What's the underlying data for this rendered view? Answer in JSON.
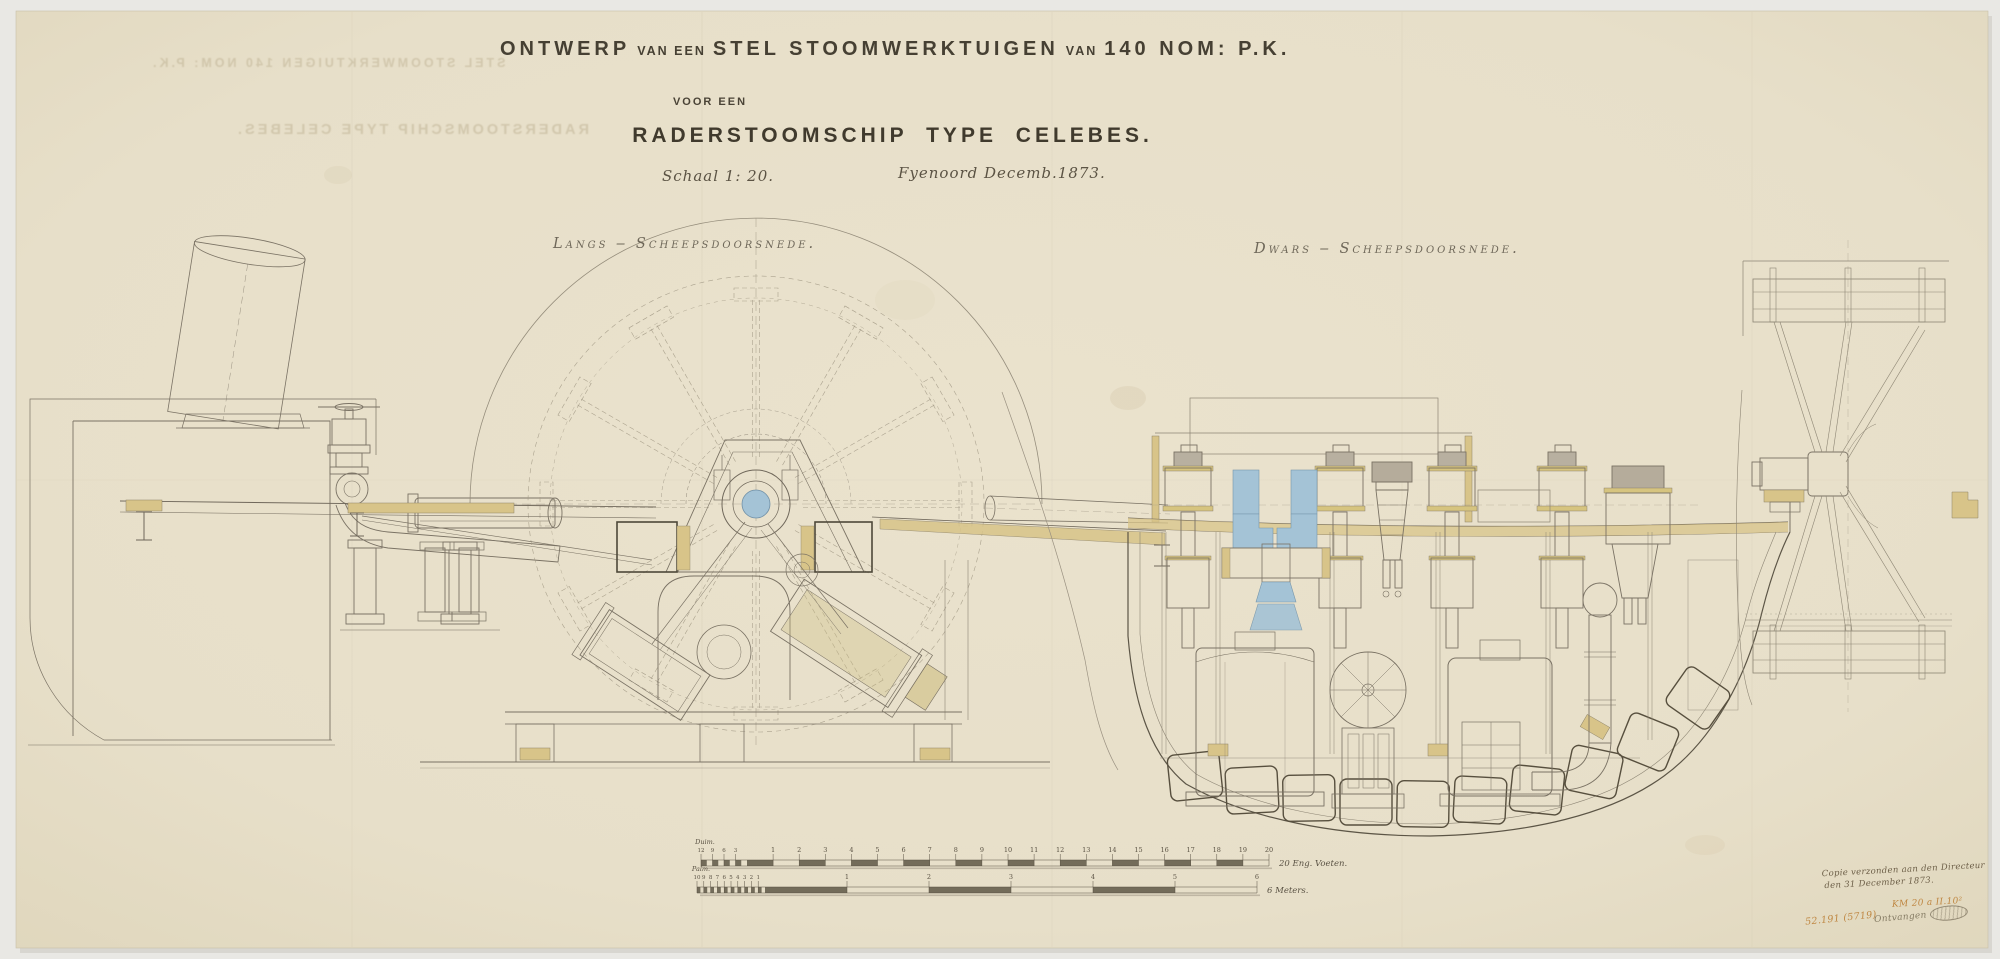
{
  "header": {
    "t1": "ONTWERP",
    "t2": "VAN EEN",
    "t3": "STEL STOOMWERKTUIGEN",
    "t4": "VAN",
    "t5": "140 NOM: P.K.",
    "subtitle": "VOOR EEN",
    "vessel_title": "RADERSTOOMSCHIP TYPE CELEBES.",
    "scale_note": "Schaal 1: 20.",
    "place_date": "Fyenoord Decemb.1873."
  },
  "section_labels": {
    "longitudinal": "Langs ‒ Scheepsdoorsnede.",
    "transverse": "Dwars ‒ Scheepsdoorsnede."
  },
  "ghost_text": {
    "line1": "STEL STOOMWERKTUIGEN  140 NOM: P.K.",
    "line2": "RADERSTOOMSCHIP TYPE CELEBES."
  },
  "scale_bars": {
    "feet": {
      "unit_label": "Duim.",
      "sub_ticks": [
        "12",
        "9",
        "6",
        "3"
      ],
      "numbers": [
        "1",
        "2",
        "3",
        "4",
        "5",
        "6",
        "7",
        "8",
        "9",
        "10",
        "11",
        "12",
        "13",
        "14",
        "15",
        "16",
        "17",
        "18",
        "19",
        "20"
      ],
      "end_label": "20 Eng. Voeten."
    },
    "meters": {
      "unit_label": "Palm.",
      "sub_ticks": [
        "10",
        "9",
        "8",
        "7",
        "6",
        "5",
        "4",
        "3",
        "2",
        "1"
      ],
      "numbers": [
        "1",
        "2",
        "3",
        "4",
        "5",
        "6"
      ],
      "end_label": "6 Meters."
    }
  },
  "annotations": {
    "sent_note_line1": "Copie verzonden aan den Directeur",
    "sent_note_line2": "den 31 December 1873.",
    "archive_code": "KM 20 a II.10²",
    "inventory_number": "52.191 (5719)",
    "received_label": "Ontvangen"
  },
  "colors": {
    "paper": "#e8e0ca",
    "background": "#e9e8e4",
    "ink": "#756d5e",
    "dark_ink": "#464033",
    "tan": "#d8c489",
    "blue": "#a4c3d6",
    "orange": "#bf8742"
  }
}
